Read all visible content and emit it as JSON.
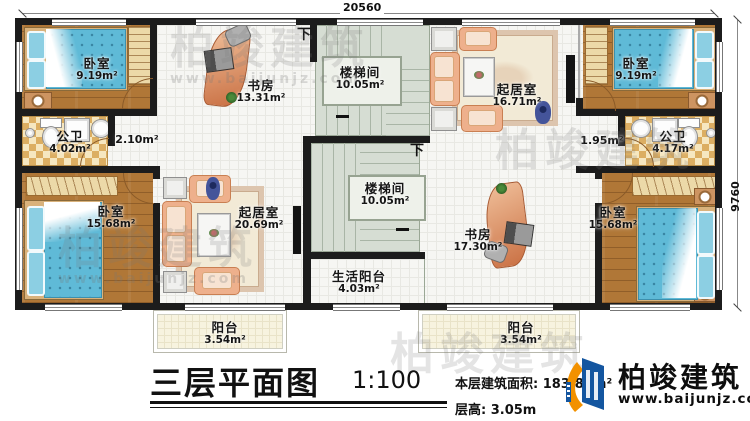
{
  "plan": {
    "dim_top": "20560",
    "dim_right": "9760",
    "down1": "下",
    "down2": "下",
    "rooms": {
      "bedroom_tl": {
        "name": "卧室",
        "area": "9.19m²"
      },
      "bedroom_tr": {
        "name": "卧室",
        "area": "9.19m²"
      },
      "bedroom_bl": {
        "name": "卧室",
        "area": "15.68m²"
      },
      "bedroom_br": {
        "name": "卧室",
        "area": "15.68m²"
      },
      "study_top": {
        "name": "书房",
        "area": "13.31m²"
      },
      "study_bottom": {
        "name": "书房",
        "area": "17.30m²"
      },
      "stair_top": {
        "name": "楼梯间",
        "area": "10.05m²"
      },
      "stair_bottom": {
        "name": "楼梯间",
        "area": "10.05m²"
      },
      "living_top": {
        "name": "起居室",
        "area": "16.71m²"
      },
      "living_bottom": {
        "name": "起居室",
        "area": "20.69m²"
      },
      "bath_left": {
        "name": "公卫",
        "area": "4.02m²"
      },
      "bath_right": {
        "name": "公卫",
        "area": "4.17m²"
      },
      "hall_left": {
        "area": "2.10m²"
      },
      "hall_right": {
        "area": "1.95m²"
      },
      "service_balcony": {
        "name": "生活阳台",
        "area": "4.03m²"
      },
      "balcony_left": {
        "name": "阳台",
        "area": "3.54m²"
      },
      "balcony_right": {
        "name": "阳台",
        "area": "3.54m²"
      }
    }
  },
  "titleblock": {
    "title": "三层平面图",
    "scale": "1:100",
    "area_label": "本层建筑面积:",
    "area_value": "183.88m²",
    "height_label": "层高:",
    "height_value": "3.05m"
  },
  "brand": {
    "name": "柏竣建筑",
    "website": "www.baijunjz.com"
  },
  "watermark": {
    "text": "柏竣建筑",
    "url": "www.baijunjz.com"
  },
  "colors": {
    "wall": "#1c1c1c",
    "wood": "#b07737",
    "bed": "#5fbad7",
    "sofa": "#eeb08c",
    "stair": "#d6ddd3",
    "brand_blue": "#1456a0",
    "brand_orange": "#f29100"
  }
}
